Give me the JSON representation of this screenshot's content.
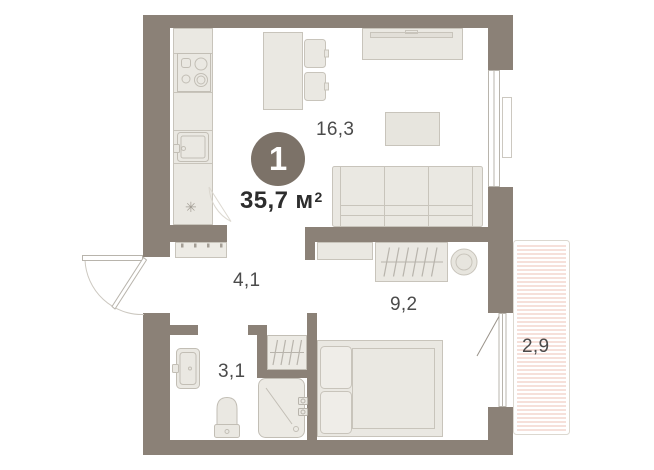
{
  "unit": {
    "number": "1",
    "total_area_value": "35,7",
    "total_area_unit": "м",
    "total_area_sup": "2"
  },
  "rooms": {
    "living_kitchen": {
      "area": "16,3"
    },
    "hallway": {
      "area": "4,1"
    },
    "bedroom": {
      "area": "9,2"
    },
    "bathroom": {
      "area": "3,1"
    },
    "balcony": {
      "area": "2,9"
    }
  },
  "icons": {
    "fridge": "✳"
  },
  "colors": {
    "wall": "#8b8177",
    "badge": "#7c7268",
    "furniture_fill": "#eae8e2",
    "furniture_stroke": "#c8c4bb",
    "balcony_hatch": "#f2cfc6",
    "room_label_text": "#4b4b4b",
    "total_area_text": "#2d2d2d"
  }
}
